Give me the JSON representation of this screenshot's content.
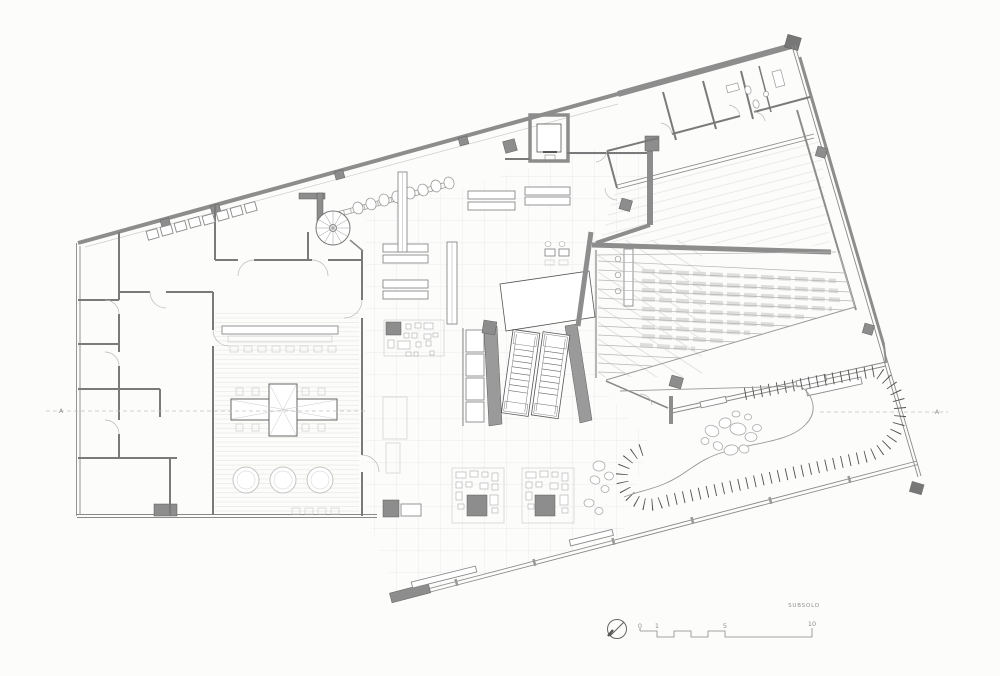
{
  "drawing": {
    "floor_label": "SUBSOLO",
    "axis_marks": {
      "left": "A",
      "right": "A"
    },
    "scale_bar": {
      "ticks": [
        "0",
        "1",
        "5",
        "10"
      ]
    },
    "colors": {
      "background": "#fcfcfa",
      "wall_gray": "#8d8d8d",
      "wall_dark": "#6e6e6e",
      "partition": "#7a7a7a",
      "thin_line": "#8a8a8a",
      "faint_line": "#d9d9d9",
      "floor_grid": "#e8e7ee",
      "axis_dash": "#c2c2c2",
      "annotation_text": "#8f8f8f"
    },
    "icons": {
      "north_arrow": "north-arrow-icon",
      "scale_bar": "graphic-scale-bar",
      "spiral_stair": "spiral-stair-icon",
      "escalators": "escalators-icon",
      "elevator": "elevator-icon"
    }
  }
}
